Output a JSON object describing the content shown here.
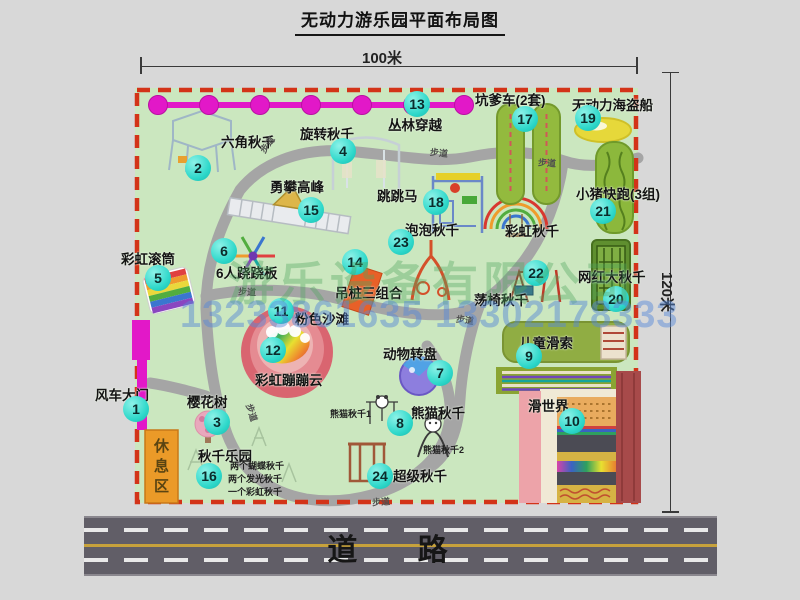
{
  "title": "无动力游乐园平面布局图",
  "dimensions": {
    "width_label": "100米",
    "height_label": "120米"
  },
  "road": {
    "label": "道  路"
  },
  "watermark": {
    "company": "游乐设备有限公司",
    "phone": "13233861635 13302178333"
  },
  "palette": {
    "marker_cyan": "#2ed8ca",
    "border_red": "#d33318",
    "gate_magenta": "#e218c8",
    "park_green": "#cbe7bf",
    "road_gray": "#615e67",
    "road_line_yellow": "#c7a23c",
    "path_gray": "#a5a5a5"
  },
  "park": {
    "markers": [
      {
        "n": "1",
        "label": "风车大门",
        "cx": 136,
        "cy": 409,
        "lx": 95,
        "ly": 384
      },
      {
        "n": "2",
        "label": "六角秋千",
        "cx": 198,
        "cy": 168,
        "lx": 221,
        "ly": 131
      },
      {
        "n": "3",
        "label": "樱花树",
        "cx": 217,
        "cy": 422,
        "lx": 187,
        "ly": 391
      },
      {
        "n": "4",
        "label": "旋转秋千",
        "cx": 343,
        "cy": 151,
        "lx": 300,
        "ly": 123
      },
      {
        "n": "5",
        "label": "彩虹滚筒",
        "cx": 158,
        "cy": 278,
        "lx": 121,
        "ly": 248
      },
      {
        "n": "6",
        "label": "6人跷跷板",
        "cx": 224,
        "cy": 251,
        "lx": 216,
        "ly": 262
      },
      {
        "n": "7",
        "label": "动物转盘",
        "cx": 440,
        "cy": 373,
        "lx": 383,
        "ly": 343
      },
      {
        "n": "8",
        "label": "熊猫秋千",
        "cx": 400,
        "cy": 423,
        "lx": 411,
        "ly": 402
      },
      {
        "n": "9",
        "label": "儿童滑索",
        "cx": 529,
        "cy": 356,
        "lx": 519,
        "ly": 332
      },
      {
        "n": "10",
        "label": "滑世界",
        "cx": 572,
        "cy": 421,
        "lx": 528,
        "ly": 395
      },
      {
        "n": "11",
        "label": "粉色沙滩",
        "cx": 281,
        "cy": 311,
        "lx": 295,
        "ly": 308
      },
      {
        "n": "12",
        "label": "彩虹蹦蹦云",
        "cx": 273,
        "cy": 350,
        "lx": 255,
        "ly": 369
      },
      {
        "n": "13",
        "label": "丛林穿越",
        "cx": 417,
        "cy": 104,
        "lx": 388,
        "ly": 114
      },
      {
        "n": "14",
        "label": "吊桩三组合",
        "cx": 355,
        "cy": 262,
        "lx": 335,
        "ly": 282
      },
      {
        "n": "15",
        "label": "勇攀高峰",
        "cx": 311,
        "cy": 210,
        "lx": 270,
        "ly": 176
      },
      {
        "n": "16",
        "label": "秋千乐园",
        "cx": 209,
        "cy": 476,
        "lx": 198,
        "ly": 445
      },
      {
        "n": "17",
        "label": "坑爹车(2套)",
        "cx": 525,
        "cy": 119,
        "lx": 475,
        "ly": 89
      },
      {
        "n": "18",
        "label": "跳跳马",
        "cx": 436,
        "cy": 202,
        "lx": 377,
        "ly": 185
      },
      {
        "n": "19",
        "label": "无动力海盗船",
        "cx": 588,
        "cy": 118,
        "lx": 572,
        "ly": 94
      },
      {
        "n": "20",
        "label": "网红大秋千",
        "cx": 616,
        "cy": 299,
        "lx": 578,
        "ly": 266
      },
      {
        "n": "21",
        "label": "小猪快跑(3组)",
        "cx": 603,
        "cy": 211,
        "lx": 576,
        "ly": 183
      },
      {
        "n": "22",
        "label": "荡椅秋千",
        "cx": 536,
        "cy": 273,
        "lx": 474,
        "ly": 289
      },
      {
        "n": "23",
        "label": "泡泡秋千",
        "cx": 401,
        "cy": 242,
        "lx": 405,
        "ly": 219
      },
      {
        "n": "24",
        "label": "超级秋千",
        "cx": 380,
        "cy": 476,
        "lx": 393,
        "ly": 465
      }
    ],
    "extra_labels": [
      {
        "text": "彩虹秋千",
        "x": 505,
        "y": 220,
        "cls": "map-label"
      },
      {
        "text": "休息区",
        "x": 150,
        "y": 438,
        "cls": "vertical-label"
      },
      {
        "text": "熊猫秋千1",
        "x": 330,
        "y": 407,
        "cls": "tiny-label"
      },
      {
        "text": "熊猫秋千2",
        "x": 423,
        "y": 443,
        "cls": "tiny-label"
      },
      {
        "text": "两个蝴蝶秋千",
        "x": 230,
        "y": 459,
        "cls": "tiny-label"
      },
      {
        "text": "两个发光秋千",
        "x": 228,
        "y": 472,
        "cls": "tiny-label"
      },
      {
        "text": "一个彩虹秋千",
        "x": 228,
        "y": 485,
        "cls": "tiny-label"
      }
    ],
    "path_labels": [
      {
        "text": "步道",
        "x": 258,
        "y": 138,
        "rot": -55
      },
      {
        "text": "步道",
        "x": 430,
        "y": 146,
        "rot": 6
      },
      {
        "text": "步道",
        "x": 538,
        "y": 156,
        "rot": 4
      },
      {
        "text": "步道",
        "x": 238,
        "y": 285,
        "rot": 3
      },
      {
        "text": "步道",
        "x": 456,
        "y": 313,
        "rot": 8
      },
      {
        "text": "步道",
        "x": 372,
        "y": 495,
        "rot": -4
      },
      {
        "text": "步道",
        "x": 243,
        "y": 406,
        "rot": 72
      }
    ]
  }
}
